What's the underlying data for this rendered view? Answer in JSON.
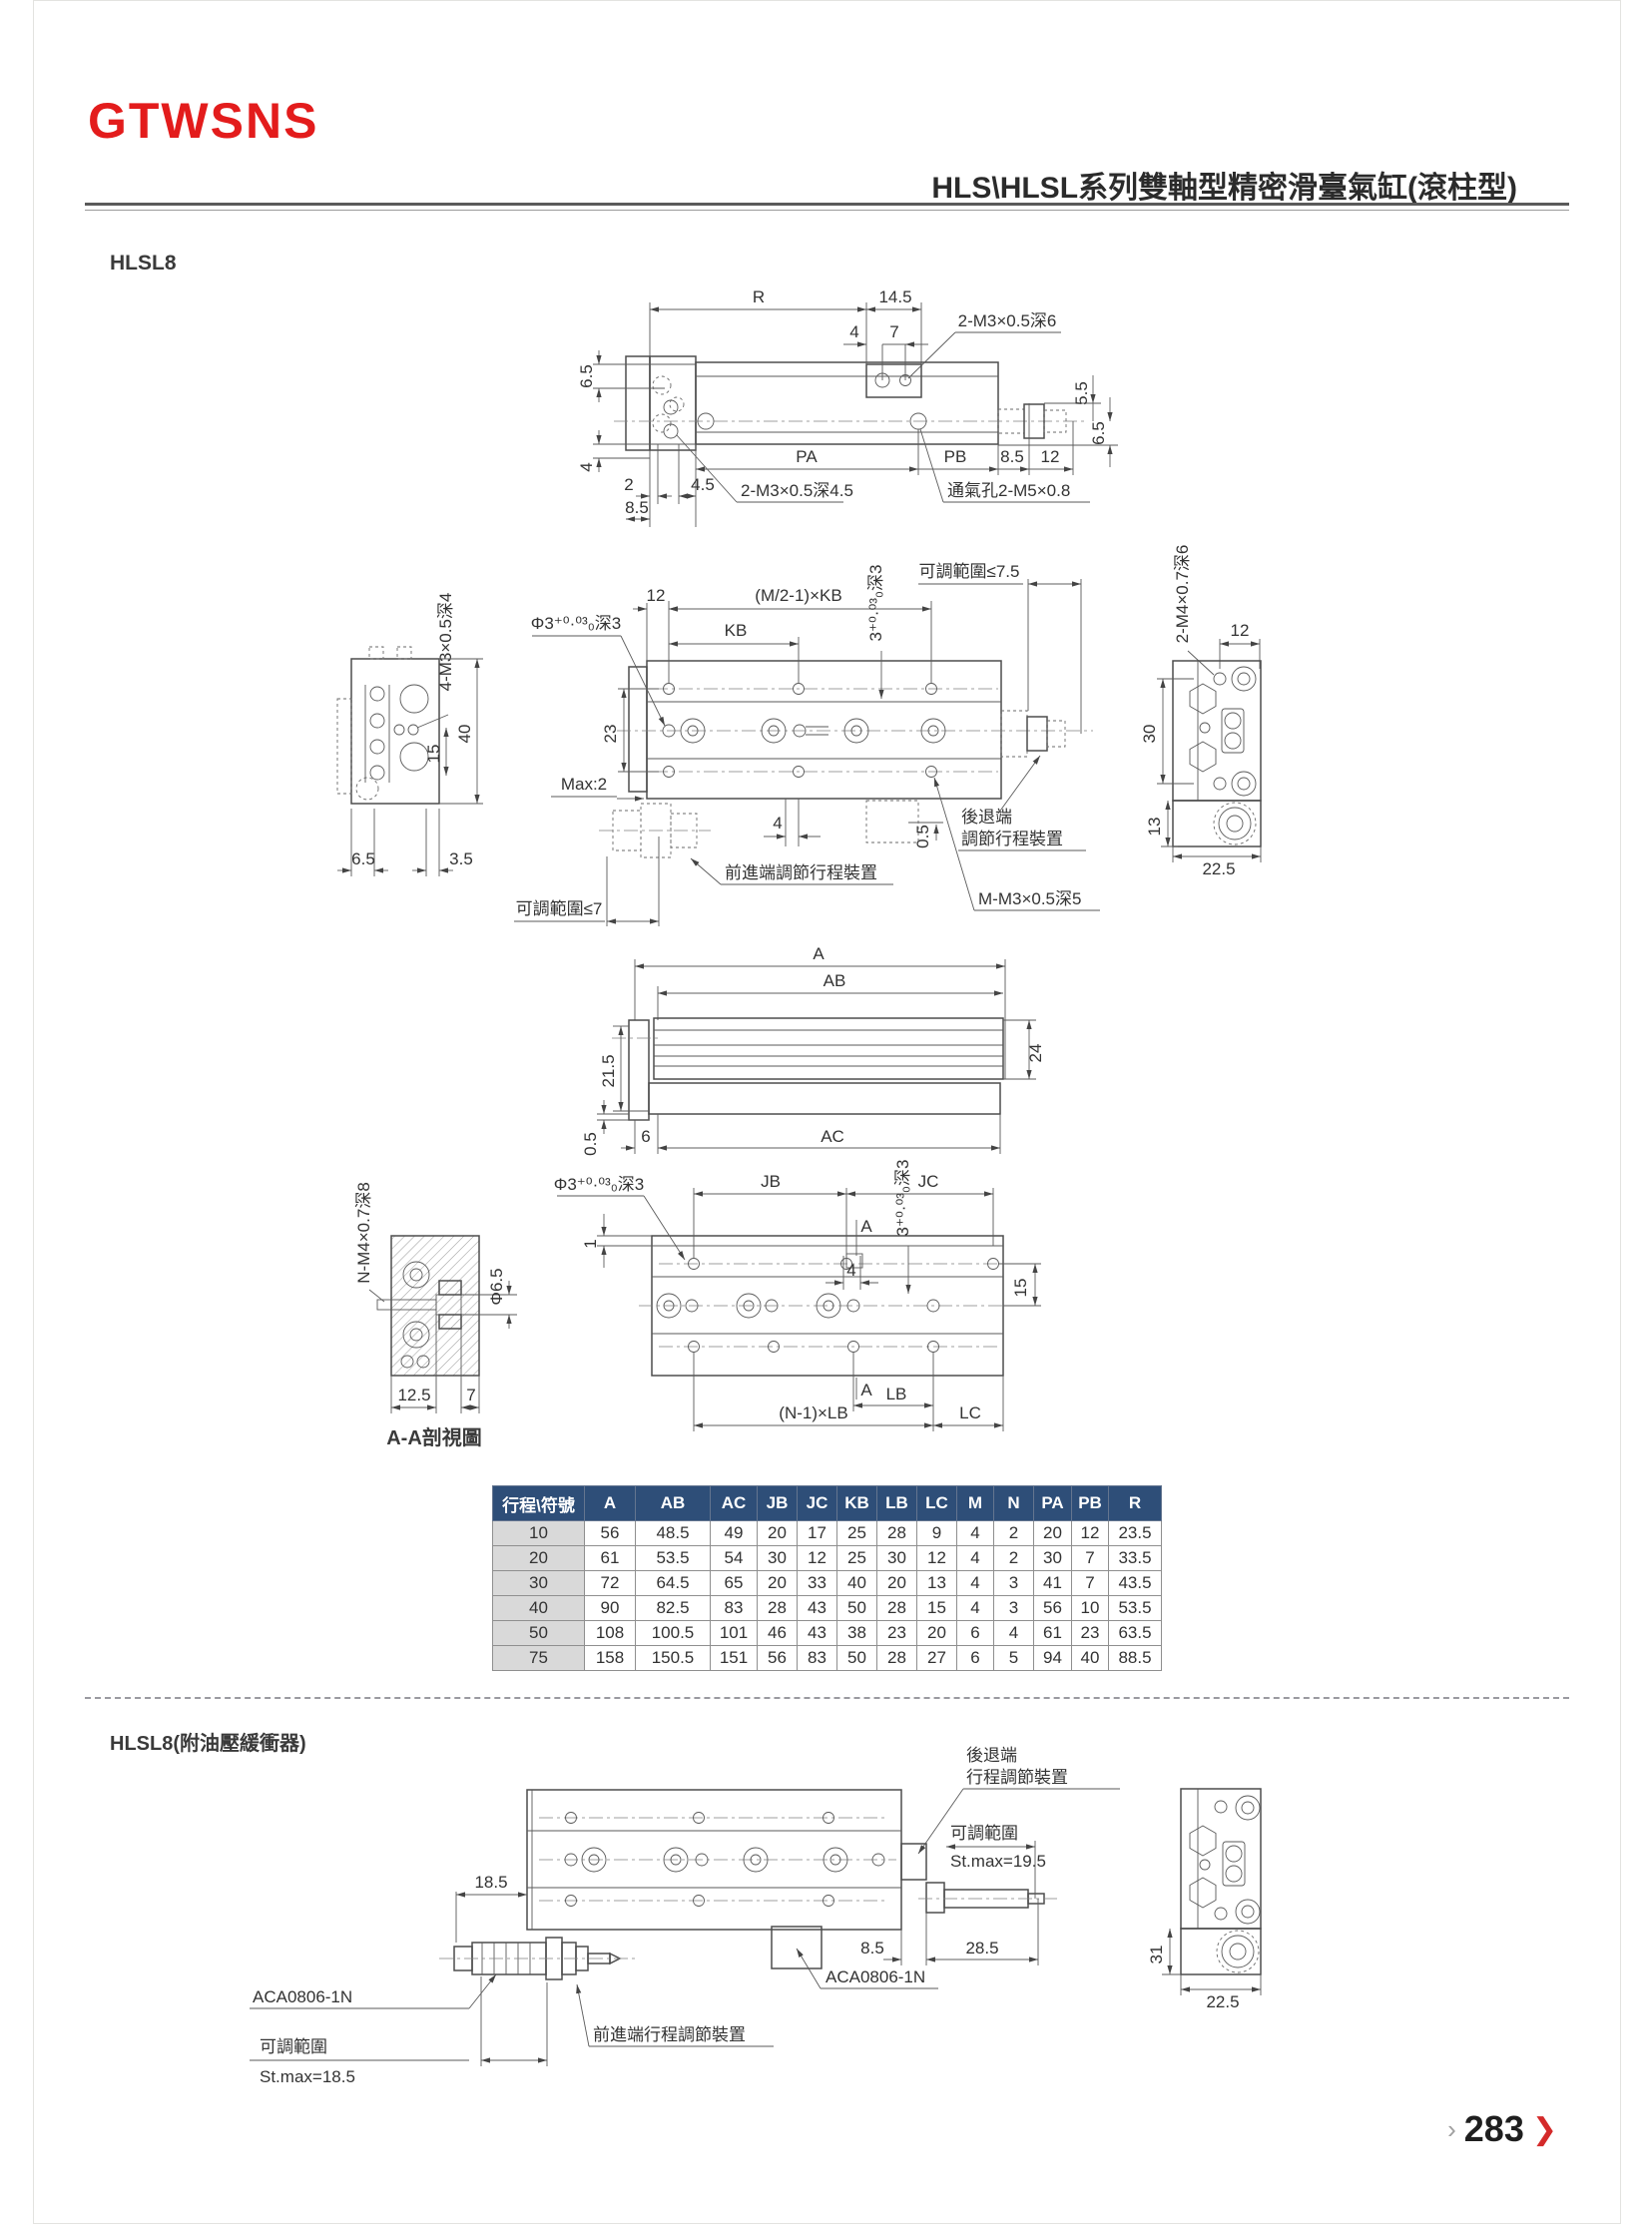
{
  "header": {
    "logo": "GTWSNS",
    "title": "HLS\\HLSL系列雙軸型精密滑臺氣缸(滾柱型)"
  },
  "sections": {
    "s1": "HLSL8",
    "s2": "HLSL8(附油壓緩衝器)"
  },
  "d1": {
    "r": "R",
    "n145": "14.5",
    "n4": "4",
    "n7": "7",
    "t1": "2-M3×0.5深6",
    "n65a": "6.5",
    "n4a": "4",
    "n2": "2",
    "n45": "4.5",
    "n85a": "8.5",
    "t2": "2-M3×0.5深4.5",
    "pa": "PA",
    "pb": "PB",
    "n85b": "8.5",
    "n12": "12",
    "t3": "通氣孔2-M5×0.8",
    "n55": "5.5",
    "n65b": "6.5"
  },
  "d2": {
    "t1": "4-M3×0.5深4",
    "n40": "40",
    "n15": "15",
    "n65": "6.5",
    "n35": "3.5",
    "n12": "12",
    "kbm": "(M/2-1)×KB",
    "kb": "KB",
    "t2": "Φ3⁺⁰·⁰³₀深3",
    "n23": "23",
    "max2": "Max:2",
    "adj75": "可調範圍≤7.5",
    "n4": "4",
    "n05": "0.5",
    "t3": "3⁺⁰·⁰³₀深3",
    "fw": "前進端調節行程裝置",
    "bk1": "後退端",
    "bk2": "調節行程裝置",
    "t4": "M-M3×0.5深5",
    "adj7": "可調範圍≤7",
    "t5": "2-M4×0.7深6",
    "n12b": "12",
    "n30": "30",
    "n13": "13",
    "n225": "22.5"
  },
  "d3": {
    "a": "A",
    "ab": "AB",
    "n215": "21.5",
    "n24": "24",
    "n05": "0.5",
    "n6": "6",
    "ac": "AC"
  },
  "d4": {
    "t1": "N-M4×0.7深8",
    "phi65": "Φ6.5",
    "n125": "12.5",
    "n7": "7",
    "cap": "A-A剖視圖",
    "t2": "Φ3⁺⁰·⁰³₀深3",
    "jb": "JB",
    "jc": "JC",
    "t3": "3⁺⁰·⁰³₀深3",
    "a1": "A",
    "n4": "4",
    "n15": "15",
    "n1": "1",
    "a2": "A",
    "lb": "LB",
    "nlb": "(N-1)×LB",
    "lc": "LC"
  },
  "d5": {
    "bk1": "後退端",
    "bk2": "行程調節裝置",
    "adj": "可調範圍",
    "st195": "St.max=19.5",
    "n185": "18.5",
    "n85": "8.5",
    "n285": "28.5",
    "aca1": "ACA0806-1N",
    "aca2": "ACA0806-1N",
    "fw": "前進端行程調節裝置",
    "adj2": "可調範圍",
    "st185": "St.max=18.5",
    "n31": "31",
    "n225": "22.5"
  },
  "table": {
    "headers": [
      "行程\\符號",
      "A",
      "AB",
      "AC",
      "JB",
      "JC",
      "KB",
      "LB",
      "LC",
      "M",
      "N",
      "PA",
      "PB",
      "R"
    ],
    "rows": [
      [
        "10",
        "56",
        "48.5",
        "49",
        "20",
        "17",
        "25",
        "28",
        "9",
        "4",
        "2",
        "20",
        "12",
        "23.5"
      ],
      [
        "20",
        "61",
        "53.5",
        "54",
        "30",
        "12",
        "25",
        "30",
        "12",
        "4",
        "2",
        "30",
        "7",
        "33.5"
      ],
      [
        "30",
        "72",
        "64.5",
        "65",
        "20",
        "33",
        "40",
        "20",
        "13",
        "4",
        "3",
        "41",
        "7",
        "43.5"
      ],
      [
        "40",
        "90",
        "82.5",
        "83",
        "28",
        "43",
        "50",
        "28",
        "15",
        "4",
        "3",
        "56",
        "10",
        "53.5"
      ],
      [
        "50",
        "108",
        "100.5",
        "101",
        "46",
        "43",
        "38",
        "23",
        "20",
        "6",
        "4",
        "61",
        "23",
        "63.5"
      ],
      [
        "75",
        "158",
        "150.5",
        "151",
        "56",
        "83",
        "50",
        "28",
        "27",
        "6",
        "5",
        "94",
        "40",
        "88.5"
      ]
    ]
  },
  "footer": {
    "chev_gray": "›",
    "page": "283",
    "chev_red": "❯"
  }
}
